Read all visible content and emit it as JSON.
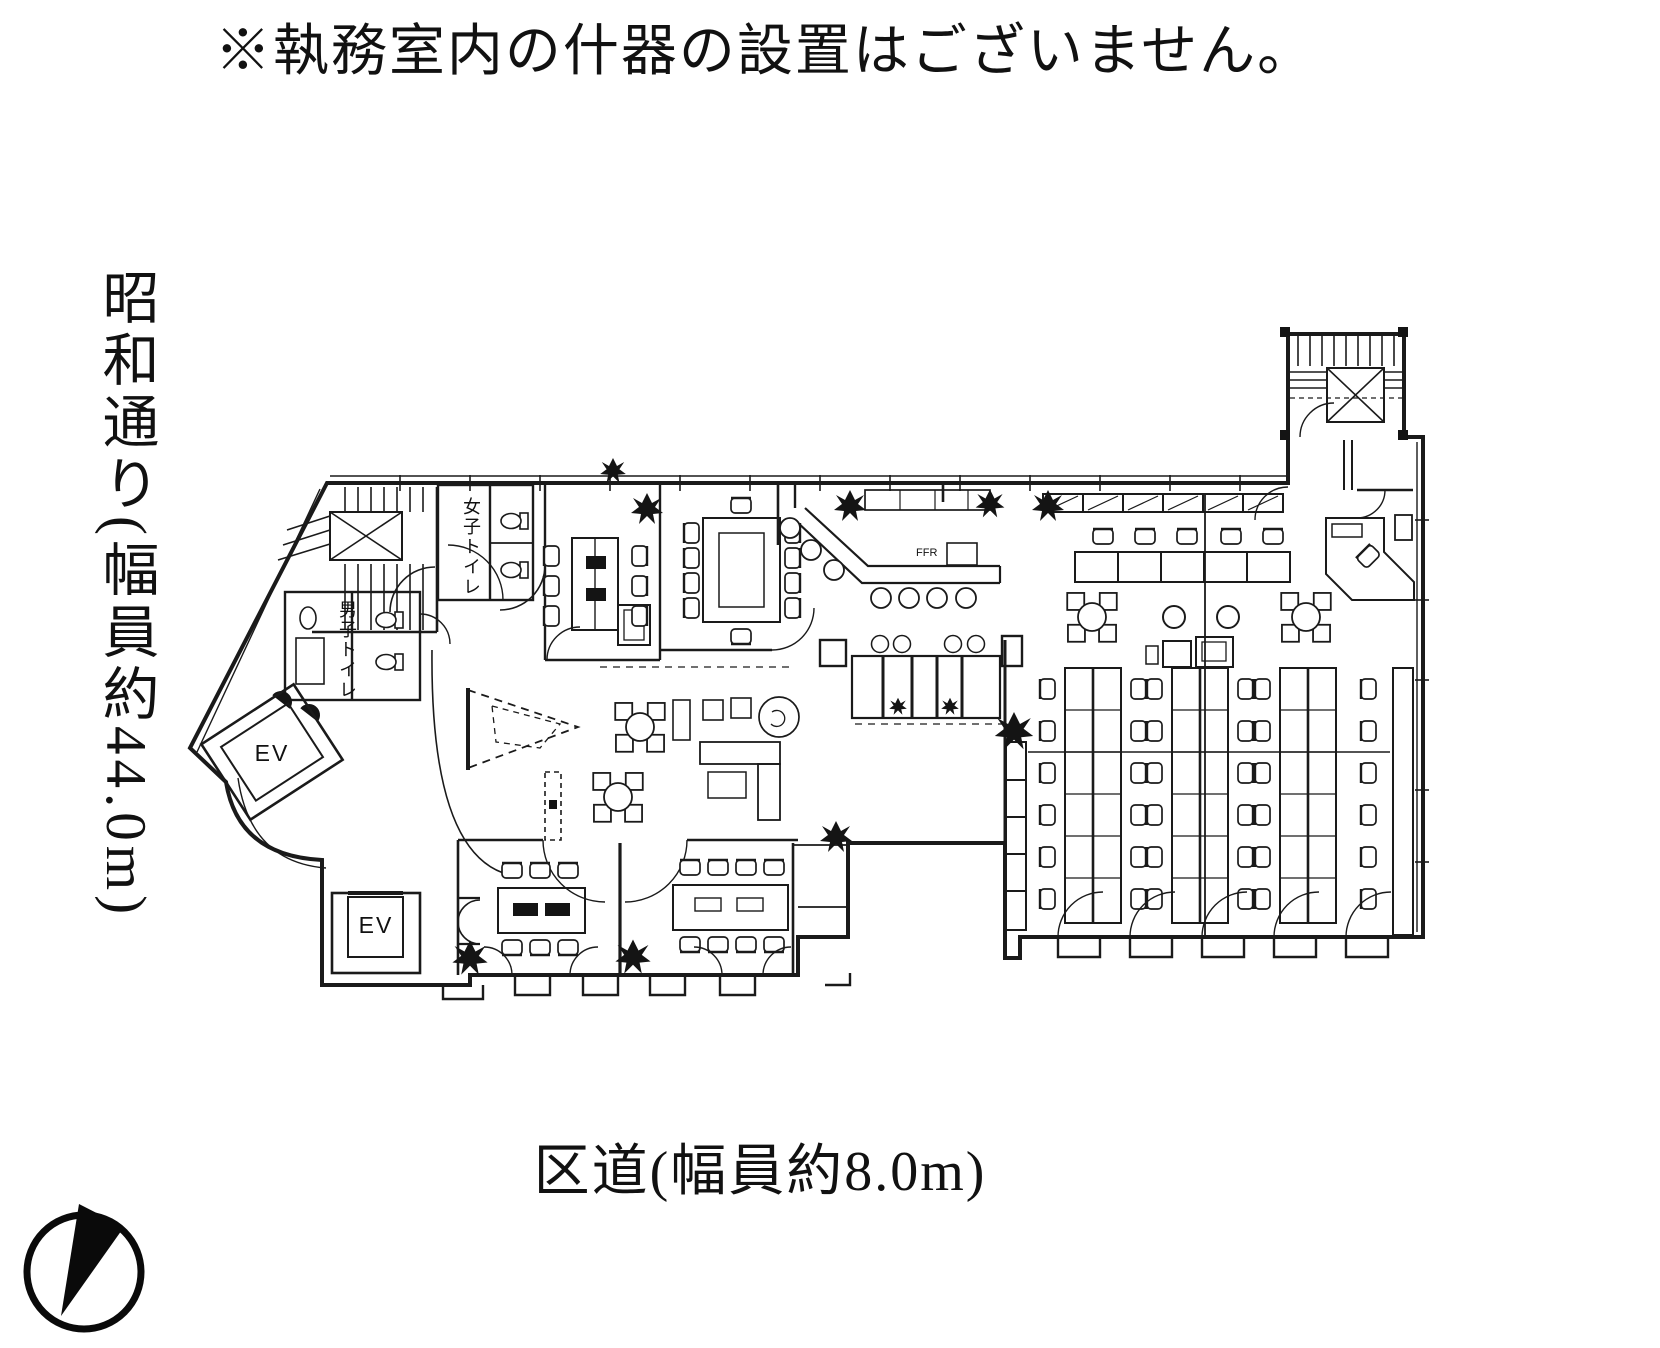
{
  "note": "※執務室内の什器の設置はございません。",
  "roads": {
    "left": "昭和通り(幅員約44.0m)",
    "bottom": "区道(幅員約8.0m)"
  },
  "floorplan": {
    "labels": {
      "elevator_upper": "EV",
      "elevator_lower": "EV",
      "womens_toilet": "女子トイレ",
      "mens_toilet": "男子トイレ",
      "counter_equipment": "FFR"
    }
  },
  "colors": {
    "ink": "#1a1a1a",
    "paper": "#ffffff"
  }
}
